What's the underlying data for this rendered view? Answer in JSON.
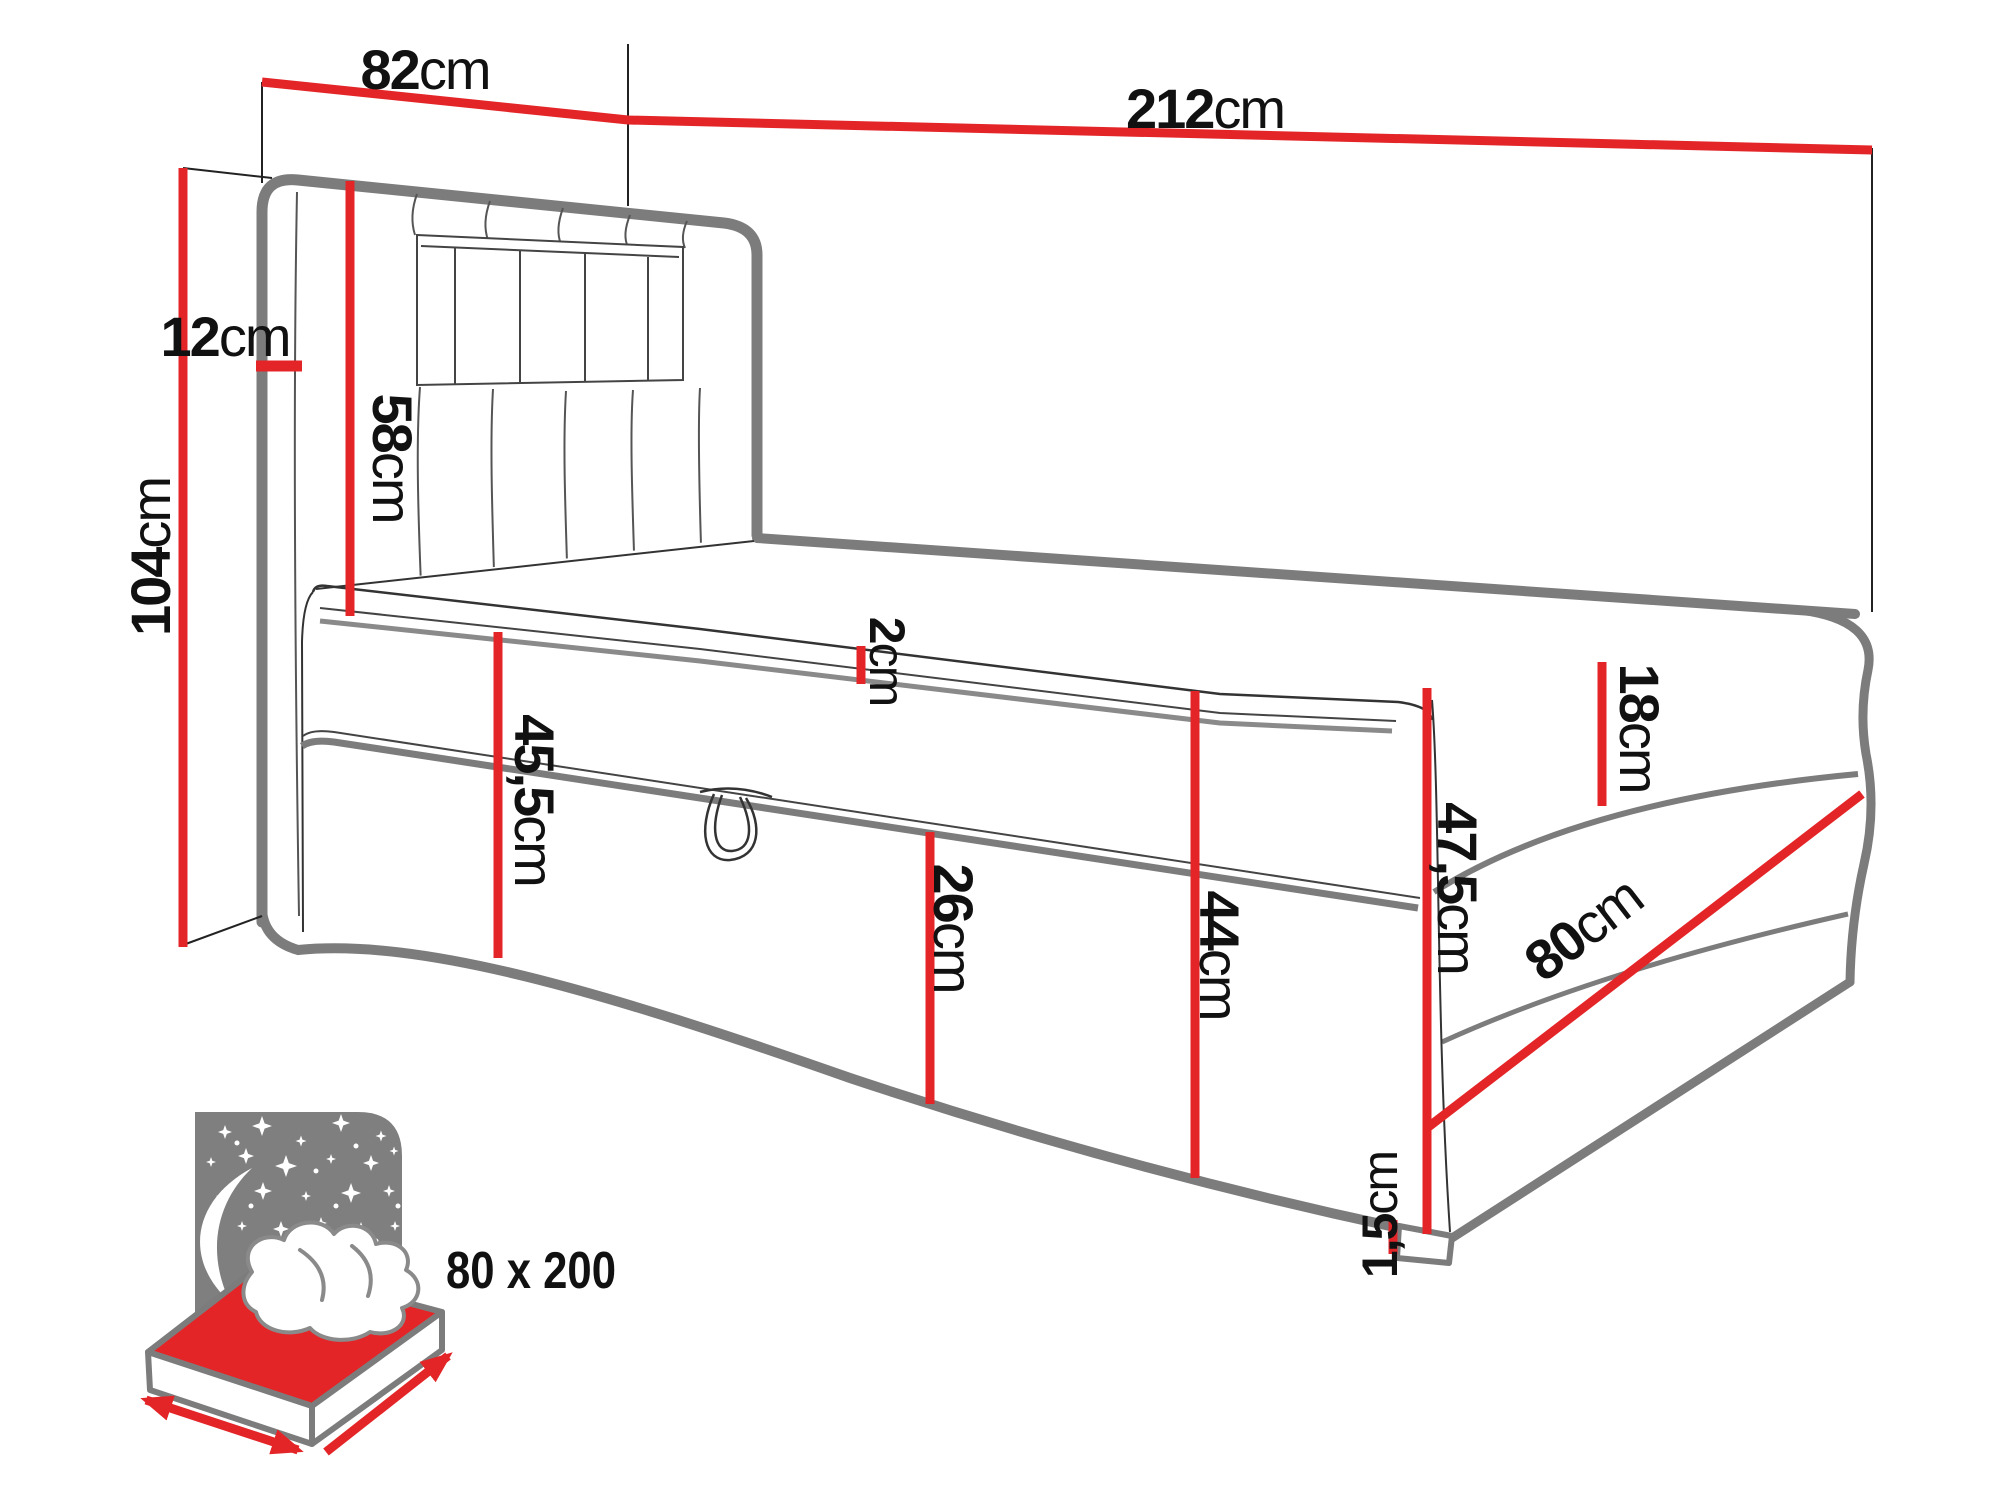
{
  "dimensions": {
    "headboard_width": {
      "num": "82",
      "unit": "cm"
    },
    "total_length": {
      "num": "212",
      "unit": "cm"
    },
    "total_height": {
      "num": "104",
      "unit": "cm"
    },
    "headboard_depth": {
      "num": "12",
      "unit": "cm"
    },
    "headboard_height": {
      "num": "58",
      "unit": "cm"
    },
    "topper_thickness": {
      "num": "2",
      "unit": "cm"
    },
    "mattress_height": {
      "num": "18",
      "unit": "cm"
    },
    "front_height": {
      "num": "45,5",
      "unit": "cm"
    },
    "storage_height": {
      "num": "26",
      "unit": "cm"
    },
    "side_height": {
      "num": "44",
      "unit": "cm"
    },
    "foot_height": {
      "num": "47,5",
      "unit": "cm"
    },
    "bed_width": {
      "num": "80",
      "unit": "cm"
    },
    "leg_clearance": {
      "num": "1,5",
      "unit": "cm"
    }
  },
  "badge": {
    "size_label": "80 x 200"
  },
  "colors": {
    "dimension_red": "#e42528",
    "outline_gray": "#7c7c7c",
    "icon_gray": "#7f7f7f",
    "line_black": "#222222",
    "label_black": "#111111"
  }
}
